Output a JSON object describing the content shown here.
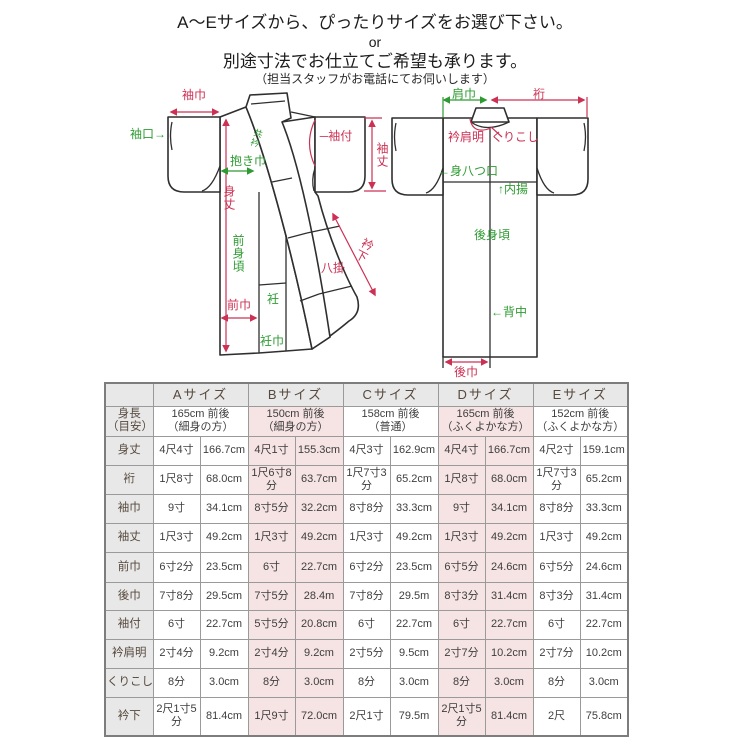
{
  "page": {
    "title_line1": "A〜Eサイズから、ぴったりサイズをお選び下さい。",
    "title_line2": "or",
    "title_line3": "別途寸法でお仕立てご希望も承ります。",
    "title_line4": "（担当スタッフがお電話にてお伺いします）"
  },
  "colors": {
    "red": "#cc3153",
    "green": "#2e9b32",
    "outline": "#2f2f2f",
    "table_border": "#9a9a9a",
    "gray_bg": "#e8e8e8",
    "pink_bg": "#f6e3e3"
  },
  "diagram": {
    "labels": [
      {
        "id": "sodehaba",
        "text": "袖巾",
        "color": "red"
      },
      {
        "id": "sodeguchi",
        "text": "袖口→",
        "color": "green"
      },
      {
        "id": "dakihaba",
        "text": "抱き巾",
        "color": "green"
      },
      {
        "id": "mitake",
        "text": "身丈",
        "color": "red"
      },
      {
        "id": "kyoueri",
        "text": "共衿",
        "color": "green"
      },
      {
        "id": "sodetsuke",
        "text": "─袖付",
        "color": "red"
      },
      {
        "id": "sodetake",
        "text": "袖丈",
        "color": "red"
      },
      {
        "id": "maemigoro",
        "text": "前身頃",
        "color": "green"
      },
      {
        "id": "maehaba",
        "text": "前巾",
        "color": "red"
      },
      {
        "id": "okumi",
        "text": "衽",
        "color": "green"
      },
      {
        "id": "okumihaba",
        "text": "衽巾",
        "color": "green"
      },
      {
        "id": "hakkake",
        "text": "八掛",
        "color": "red"
      },
      {
        "id": "erishita",
        "text": "衿下",
        "color": "red"
      },
      {
        "id": "katahaba",
        "text": "肩巾",
        "color": "green"
      },
      {
        "id": "yuki",
        "text": "裄",
        "color": "red"
      },
      {
        "id": "erikataaki",
        "text": "衿肩明",
        "color": "red"
      },
      {
        "id": "kurikoshi",
        "text": "くりこし",
        "color": "red"
      },
      {
        "id": "miyatsuguchi",
        "text": "←身八つ口",
        "color": "green"
      },
      {
        "id": "uchiage",
        "text": "↑内揚",
        "color": "green"
      },
      {
        "id": "ushiromigoro",
        "text": "後身頃",
        "color": "green"
      },
      {
        "id": "senaka",
        "text": "←背中",
        "color": "green"
      },
      {
        "id": "ushirohaba",
        "text": "後巾",
        "color": "red"
      }
    ]
  },
  "table": {
    "corner": "",
    "size_headers": [
      "Aサイズ",
      "Bサイズ",
      "Cサイズ",
      "Dサイズ",
      "Eサイズ"
    ],
    "height_label": [
      "身長",
      "（目安）"
    ],
    "height_cells": [
      [
        "165cm 前後",
        "（細身の方）"
      ],
      [
        "150cm 前後",
        "（細身の方）"
      ],
      [
        "158cm 前後",
        "（普通）"
      ],
      [
        "165cm 前後",
        "（ふくよかな方）"
      ],
      [
        "152cm 前後",
        "（ふくよかな方）"
      ]
    ],
    "rows": [
      {
        "label": "身丈",
        "cells": [
          [
            "4尺4寸",
            "166.7cm"
          ],
          [
            "4尺1寸",
            "155.3cm"
          ],
          [
            "4尺3寸",
            "162.9cm"
          ],
          [
            "4尺4寸",
            "166.7cm"
          ],
          [
            "4尺2寸",
            "159.1cm"
          ]
        ]
      },
      {
        "label": "裄",
        "cells": [
          [
            "1尺8寸",
            "68.0cm"
          ],
          [
            "1尺6寸8分",
            "63.7cm"
          ],
          [
            "1尺7寸3分",
            "65.2cm"
          ],
          [
            "1尺8寸",
            "68.0cm"
          ],
          [
            "1尺7寸3分",
            "65.2cm"
          ]
        ]
      },
      {
        "label": "袖巾",
        "cells": [
          [
            "9寸",
            "34.1cm"
          ],
          [
            "8寸5分",
            "32.2cm"
          ],
          [
            "8寸8分",
            "33.3cm"
          ],
          [
            "9寸",
            "34.1cm"
          ],
          [
            "8寸8分",
            "33.3cm"
          ]
        ]
      },
      {
        "label": "袖丈",
        "cells": [
          [
            "1尺3寸",
            "49.2cm"
          ],
          [
            "1尺3寸",
            "49.2cm"
          ],
          [
            "1尺3寸",
            "49.2cm"
          ],
          [
            "1尺3寸",
            "49.2cm"
          ],
          [
            "1尺3寸",
            "49.2cm"
          ]
        ]
      },
      {
        "label": "前巾",
        "cells": [
          [
            "6寸2分",
            "23.5cm"
          ],
          [
            "6寸",
            "22.7cm"
          ],
          [
            "6寸2分",
            "23.5cm"
          ],
          [
            "6寸5分",
            "24.6cm"
          ],
          [
            "6寸5分",
            "24.6cm"
          ]
        ]
      },
      {
        "label": "後巾",
        "cells": [
          [
            "7寸8分",
            "29.5cm"
          ],
          [
            "7寸5分",
            "28.4m"
          ],
          [
            "7寸8分",
            "29.5m"
          ],
          [
            "8寸3分",
            "31.4cm"
          ],
          [
            "8寸3分",
            "31.4cm"
          ]
        ]
      },
      {
        "label": "袖付",
        "cells": [
          [
            "6寸",
            "22.7cm"
          ],
          [
            "5寸5分",
            "20.8cm"
          ],
          [
            "6寸",
            "22.7cm"
          ],
          [
            "6寸",
            "22.7cm"
          ],
          [
            "6寸",
            "22.7cm"
          ]
        ]
      },
      {
        "label": "衿肩明",
        "cells": [
          [
            "2寸4分",
            "9.2cm"
          ],
          [
            "2寸4分",
            "9.2cm"
          ],
          [
            "2寸5分",
            "9.5cm"
          ],
          [
            "2寸7分",
            "10.2cm"
          ],
          [
            "2寸7分",
            "10.2cm"
          ]
        ]
      },
      {
        "label": "くりこし",
        "cells": [
          [
            "8分",
            "3.0cm"
          ],
          [
            "8分",
            "3.0cm"
          ],
          [
            "8分",
            "3.0cm"
          ],
          [
            "8分",
            "3.0cm"
          ],
          [
            "8分",
            "3.0cm"
          ]
        ]
      },
      {
        "label": "衿下",
        "cells": [
          [
            "2尺1寸5分",
            "81.4cm"
          ],
          [
            "1尺9寸",
            "72.0cm"
          ],
          [
            "2尺1寸",
            "79.5m"
          ],
          [
            "2尺1寸5分",
            "81.4cm"
          ],
          [
            "2尺",
            "75.8cm"
          ]
        ]
      }
    ]
  }
}
